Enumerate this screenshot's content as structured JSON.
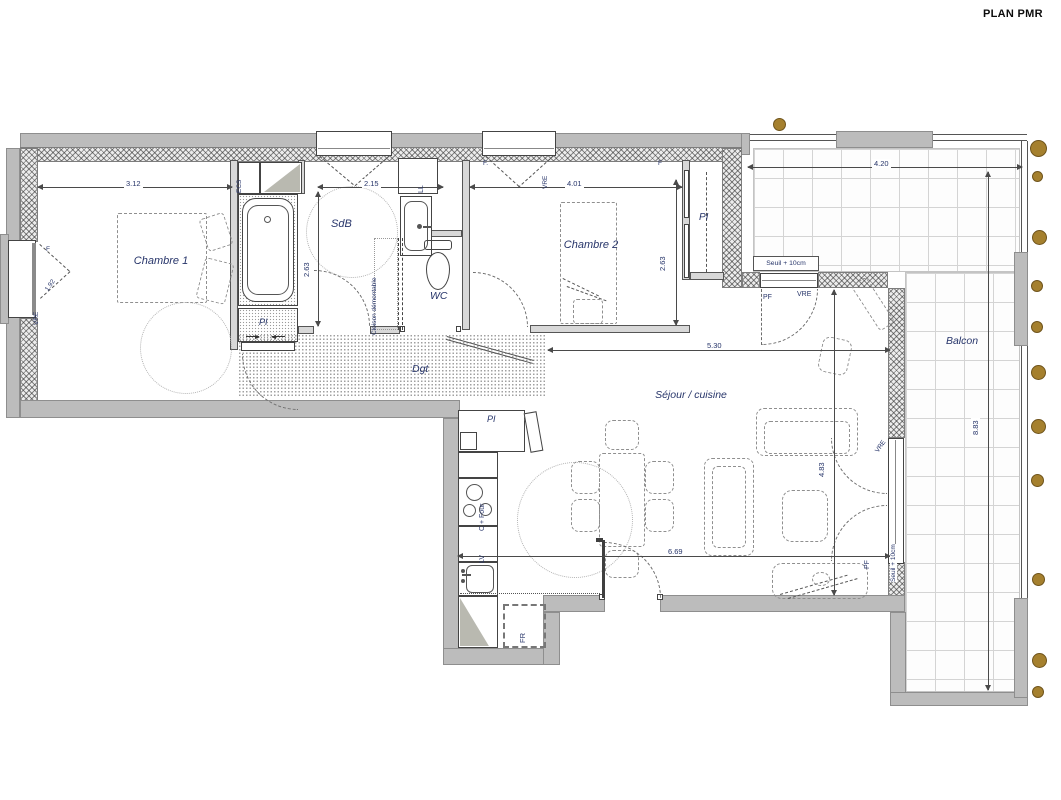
{
  "title": "PLAN PMR",
  "rooms": {
    "chambre1": "Chambre 1",
    "chambre2": "Chambre 2",
    "sdb": "SdB",
    "wc": "WC",
    "dgt": "Dgt",
    "sejour": "Séjour / cuisine",
    "balcon": "Balcon"
  },
  "dims": {
    "w_chambre1": "3.12",
    "w_sdb": "2.15",
    "w_chambre2": "4.01",
    "w_balcon": "4.20",
    "h_sdb": "2.63",
    "h_chambre2": "2.63",
    "w_sejour": "5.30",
    "w_sejour_bas": "6.69",
    "h_sejour": "4.83",
    "h_balcon": "8.83",
    "w_fenetre": "1.92"
  },
  "tags": {
    "pi": "PI",
    "ecs": "ECS",
    "ll": "LL",
    "fr": "FR",
    "lv": "LV",
    "cfour": "C + Four",
    "cloison": "Cloison démontable",
    "seuil": "Seuil + 10cm",
    "f": "F",
    "fdot": "F.",
    "pf": "PF",
    "vre": "VRE"
  },
  "colors": {
    "post_dot": "#a5802e",
    "wall_grey": "#bcbcbc",
    "label_navy": "#27356a"
  }
}
